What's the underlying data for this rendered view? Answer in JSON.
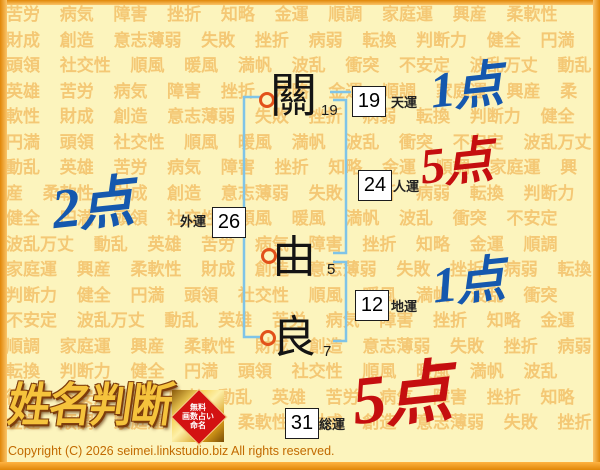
{
  "background_words": [
    "苦労",
    "病気",
    "障害",
    "挫折",
    "知略",
    "金運",
    "順調",
    "家庭運",
    "興産",
    "柔軟性",
    "財成",
    "創造",
    "意志薄弱",
    "失敗",
    "挫折",
    "病弱",
    "転換",
    "判断力",
    "健全",
    "円満",
    "頭領",
    "社交性",
    "順風",
    "暖風",
    "満帆",
    "波乱",
    "衝突",
    "不安定",
    "波乱万丈",
    "動乱",
    "英雄"
  ],
  "name": {
    "characters": [
      {
        "char": "關",
        "strokes": "19"
      },
      {
        "char": "由",
        "strokes": "5"
      },
      {
        "char": "良",
        "strokes": "7"
      }
    ]
  },
  "fortunes": {
    "ten": {
      "label": "天運",
      "value": "19",
      "score": "1点"
    },
    "jin": {
      "label": "人運",
      "value": "24",
      "score": "5点"
    },
    "chi": {
      "label": "地運",
      "value": "12",
      "score": "1点"
    },
    "gai": {
      "label": "外運",
      "value": "26",
      "score": "2点"
    },
    "sou": {
      "label": "総運",
      "value": "31",
      "score": "5点"
    }
  },
  "logo": {
    "title": "姓名判断",
    "badge_lines": [
      "無料",
      "画数占い",
      "命名"
    ]
  },
  "copyright": "Copyright (C) 2026 seimei.linkstudio.biz All rights reserved.",
  "colors": {
    "background": "#FCF4BD",
    "watermark_text": "#EE9E30",
    "bracket_blue": "#7FC4E8",
    "circle_orange": "#E2511A",
    "score_blue": "#1558AE",
    "score_red": "#C50F0F",
    "logo_gold": "#F5C33C",
    "badge_red": "#D31212",
    "copyright_orange": "#C26A00",
    "frame_orange": "#F2A024"
  }
}
